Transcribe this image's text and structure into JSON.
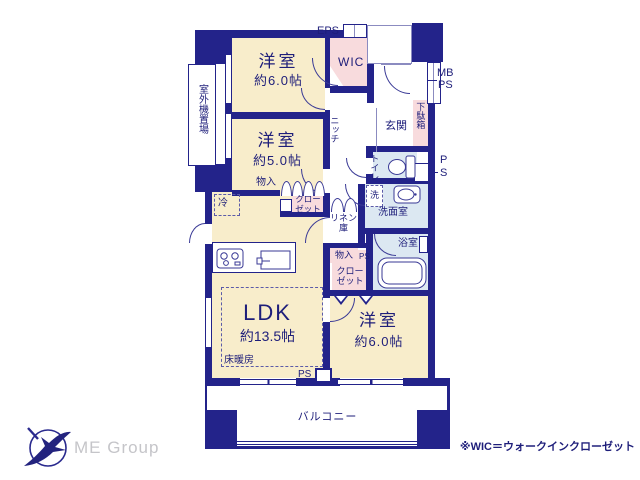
{
  "colors": {
    "wall": "#23238a",
    "room_fill": "#f8edcb",
    "storage_fill": "#f8dbdd",
    "wet_fill": "#dce8f2",
    "label_text": "#1e1e7a",
    "logo_gray": "#c5c5c9"
  },
  "rooms": {
    "bedroom_top": {
      "label": "洋室",
      "size": "約6.0帖"
    },
    "bedroom_mid": {
      "label": "洋室",
      "size": "約5.0帖"
    },
    "ldk": {
      "label": "LDK",
      "size": "約13.5帖"
    },
    "bedroom_bottom": {
      "label": "洋室",
      "size": "約6.0帖"
    }
  },
  "features": {
    "wic": "WIC",
    "eps": "EPS",
    "mb": "MB",
    "ps": "PS",
    "genkan": "玄関",
    "shoe_cabinet": "下駄箱",
    "toilet": "トイレ",
    "washer": "洗",
    "washroom": "洗面室",
    "bathroom": "浴室",
    "linen": "リネン庫",
    "storage": "物入",
    "closet": "クローゼット",
    "niche": "ニッチ",
    "fridge": "冷",
    "floor_heating": "床暖房",
    "balcony": "バルコニー",
    "outdoor_unit": "室外機置場"
  },
  "footer": {
    "note": "※WIC＝ウォークインクローゼット",
    "logo_text": "ME Group"
  }
}
